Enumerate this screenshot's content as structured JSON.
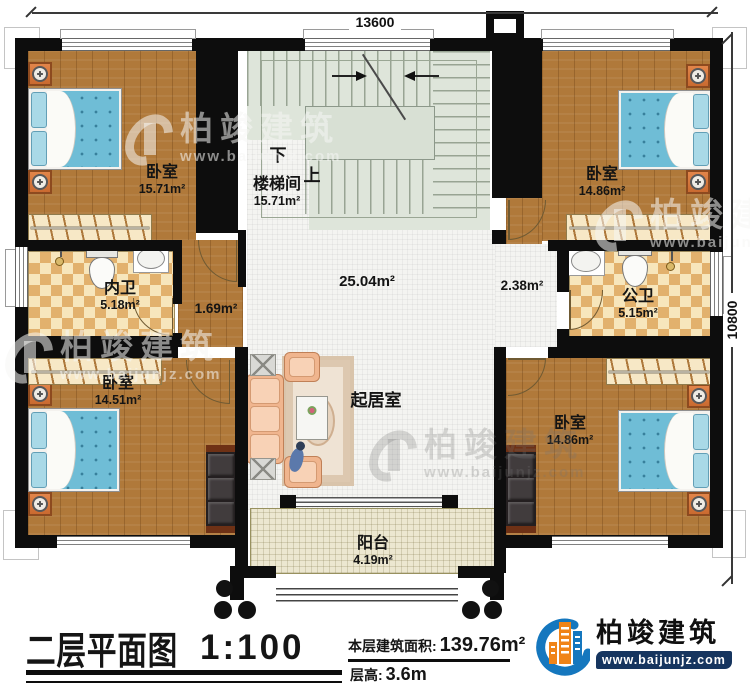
{
  "dimensions": {
    "top": "13600",
    "right": "10800"
  },
  "watermark": {
    "brand": "柏竣建筑",
    "url": "www.baijunjz.com"
  },
  "rooms": {
    "bedroom_tl": {
      "label": "卧室",
      "area": "15.71m²"
    },
    "stair": {
      "label": "楼梯间",
      "area": "15.71m²",
      "down": "下",
      "up": "上"
    },
    "bedroom_tr": {
      "label": "卧室",
      "area": "14.86m²"
    },
    "bath_inner": {
      "label": "内卫",
      "area": "5.18m²"
    },
    "bath_public": {
      "label": "公卫",
      "area": "5.15m²"
    },
    "bedroom_bl": {
      "label": "卧室",
      "area": "14.51m²"
    },
    "bedroom_br": {
      "label": "卧室",
      "area": "14.86m²"
    },
    "living": {
      "label": "起居室"
    },
    "balcony": {
      "label": "阳台",
      "area": "4.19m²"
    },
    "hall": {
      "area": "25.04m²"
    },
    "corridor_left": {
      "area": "1.69m²"
    },
    "corridor_right": {
      "area": "2.38m²"
    }
  },
  "title_block": {
    "title": "二层平面图",
    "scale": "1:100",
    "floor_area_label": "本层建筑面积:",
    "floor_area_value": "139.76m²",
    "floor_height_label": "层高:",
    "floor_height_value": "3.6m"
  },
  "logo": {
    "brand": "柏竣建筑",
    "url": "www.baijunjz.com"
  },
  "colors": {
    "brand_blue": "#1577be",
    "brand_orange": "#f08418",
    "url_bar_navy": "#16355f",
    "wall_black": "#0d0d0d",
    "wood_floor": "#b0793a",
    "bath_tile_tan": "#e2b16d",
    "stair_green": "#dee5da",
    "balcony_beige": "#ece7d0"
  }
}
